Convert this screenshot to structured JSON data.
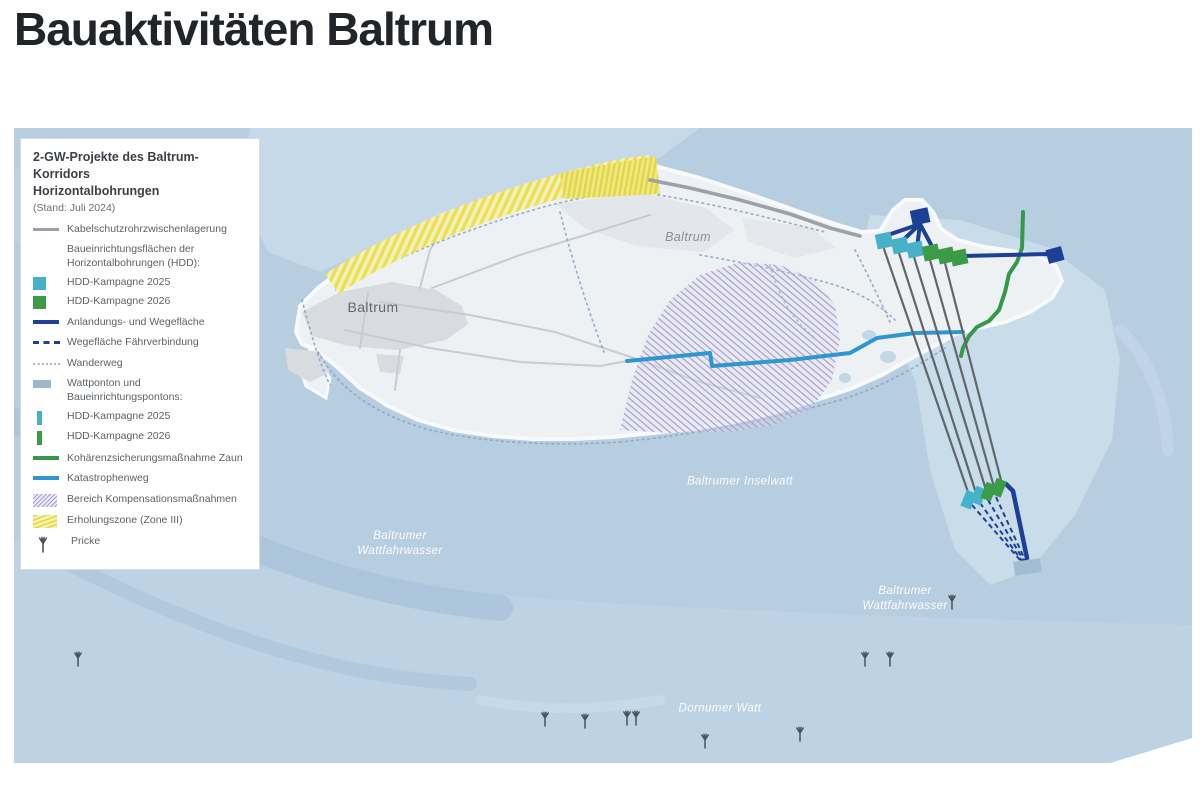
{
  "page": {
    "title": "Bauaktivitäten Baltrum"
  },
  "legend": {
    "title_line1": "2-GW-Projekte des Baltrum-Korridors",
    "title_line2": "Horizontalbohrungen",
    "date_note": "(Stand: Juli 2024)",
    "items": [
      {
        "type": "line-gray",
        "label": "Kabelschutzrohrzwischenlagerung"
      },
      {
        "type": "header",
        "label": "Baueinrichtungsflächen der Horizontalbohrungen (HDD):"
      },
      {
        "type": "square-cyan",
        "label": "HDD-Kampagne 2025"
      },
      {
        "type": "square-green",
        "label": "HDD-Kampagne 2026"
      },
      {
        "type": "line-navy",
        "label": "Anlandungs- und Wegefläche"
      },
      {
        "type": "line-navy-dashed",
        "label": "Wegefläche Fährverbindung"
      },
      {
        "type": "line-dotted",
        "label": "Wanderweg"
      },
      {
        "type": "rect-steel",
        "label": "Wattponton und Baueinrichtungspontons:"
      },
      {
        "type": "bar-cyan",
        "label": "HDD-Kampagne 2025"
      },
      {
        "type": "bar-green",
        "label": "HDD-Kampagne 2026"
      },
      {
        "type": "line-green",
        "label": "Kohärenzsicherungsmaßnahme Zaun"
      },
      {
        "type": "line-blue",
        "label": "Katastrophenweg"
      },
      {
        "type": "hatch-purple",
        "label": "Bereich Kompensationsmaßnahmen"
      },
      {
        "type": "hatch-yellow",
        "label": "Erholungszone (Zone III)"
      },
      {
        "type": "pricke",
        "label": "Pricke"
      }
    ]
  },
  "map": {
    "labels": {
      "island_west": "Baltrum",
      "island_east": "Baltrum",
      "fairway_west_line1": "Baltrumer",
      "fairway_west_line2": "Wattfahrwasser",
      "inselwatt": "Baltrumer Inselwatt",
      "fairway_east_line1": "Baltrumer",
      "fairway_east_line2": "Wattfahrwasser",
      "dornumer_watt": "Dornumer Watt"
    },
    "colors": {
      "water": "#b7cde0",
      "island": "#eef1f4",
      "hdd_2025": "#47b1c9",
      "hdd_2026": "#3c9b47",
      "anlandung_navy": "#1d3f96",
      "katastrophenweg": "#2f96d2",
      "zaun_green": "#35984a",
      "kabelschutzrohr_gray": "#9ba1a8",
      "erholungszone_yellow": "#e9df5e",
      "kompensation_purple": "#a79fce",
      "wattponton": "#a3bdd0"
    }
  }
}
